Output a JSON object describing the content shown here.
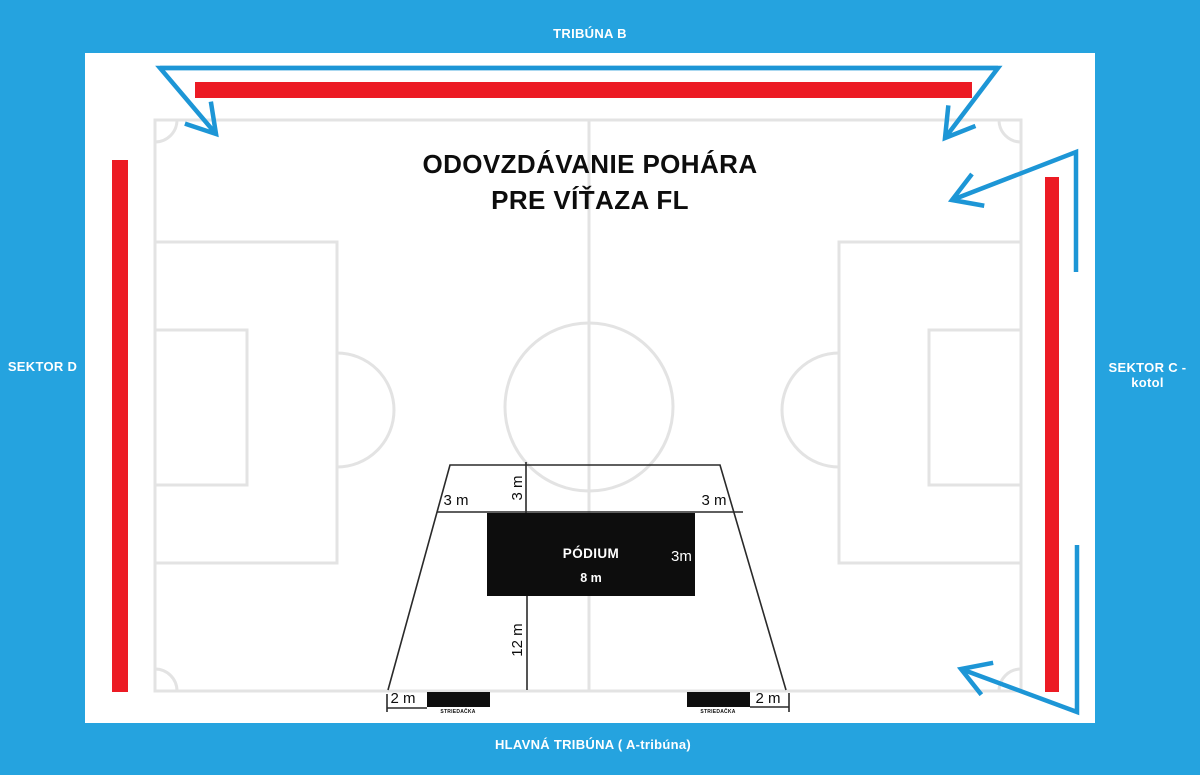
{
  "colors": {
    "bg": "#25A3DF",
    "arrow": "#1D96D6",
    "red": "#EC1B24",
    "pitch": "#E3E3E3",
    "line": "#2A2A2A",
    "black": "#0D0D0D"
  },
  "stands": {
    "top": "TRIBÚNA B",
    "left": "SEKTOR D",
    "right": "SEKTOR C - kotol",
    "bottom": "HLAVNÁ TRIBÚNA ( A-tribúna)"
  },
  "title": {
    "line1": "ODOVZDÁVANIE POHÁRA",
    "line2": "PRE VÍŤAZA FL"
  },
  "podium": {
    "label": "PÓDIUM",
    "width_label": "8 m",
    "depth_label": "3m"
  },
  "dimensions": {
    "front_left": "3 m",
    "front_right": "3 m",
    "front_depth": "3 m",
    "back_depth": "12 m",
    "bench_gap_left": "2 m",
    "bench_gap_right": "2 m"
  },
  "benches": {
    "left_label": "STRIEDAČKA",
    "right_label": "STRIEDAČKA"
  }
}
